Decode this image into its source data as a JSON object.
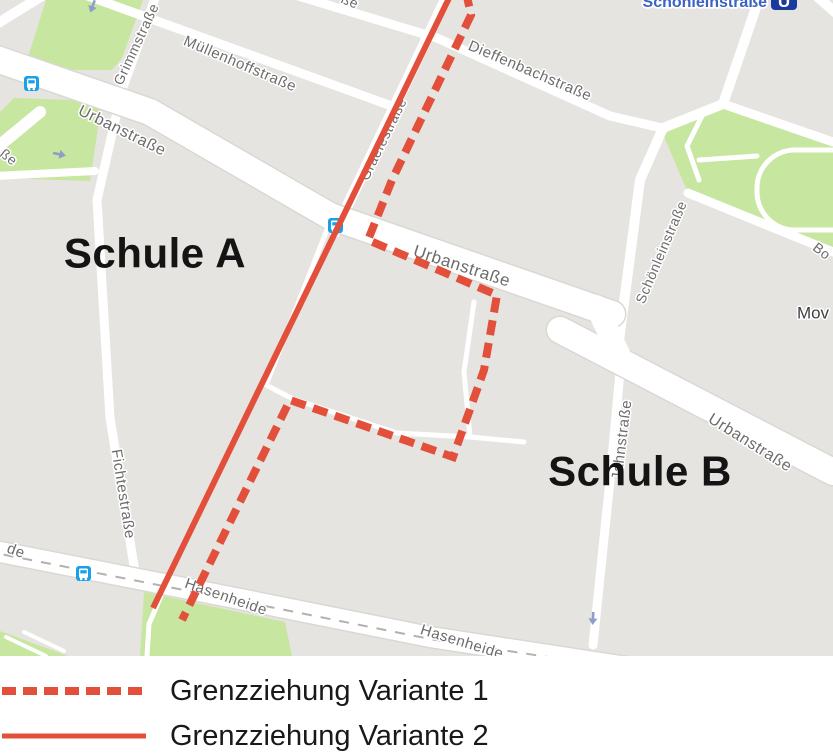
{
  "map": {
    "colors": {
      "land": "#e6e4e0",
      "park": "#c7e6a0",
      "road": "#ffffff",
      "bus_blue": "#18a0e8",
      "ubahn_blue": "#1b3a9e",
      "station_label_blue": "#3a63c4",
      "street_label_gray": "#6c6c6c"
    },
    "streets": {
      "grimmstrasse": "Grimmstraße",
      "muellenhoffstrasse": "Müllenhoffstraße",
      "dieffenbachstrasse": "Dieffenbachstraße",
      "urbanstrasse": "Urbanstraße",
      "graefestrasse": "Graefestraße",
      "schoenleinstrasse": "Schönleinstraße",
      "fichtestrasse": "Fichtestraße",
      "jahnstrasse": "Jahnstraße",
      "hasenheide": "Hasenheide"
    },
    "fragments": {
      "sse": "ße",
      "de": "de",
      "bo": "Bo"
    },
    "poi": {
      "mov": "Mov"
    },
    "station": {
      "name": "Schönleinstraße",
      "symbol": "U"
    }
  },
  "overlay": {
    "school_a": "Schule A",
    "school_b": "Schule B"
  },
  "legend": {
    "line_color": "#e2503c",
    "items": [
      {
        "label": "Grenzziehung Variante 1",
        "style": "dashed"
      },
      {
        "label": "Grenzziehung Variante 2",
        "style": "solid"
      }
    ]
  }
}
